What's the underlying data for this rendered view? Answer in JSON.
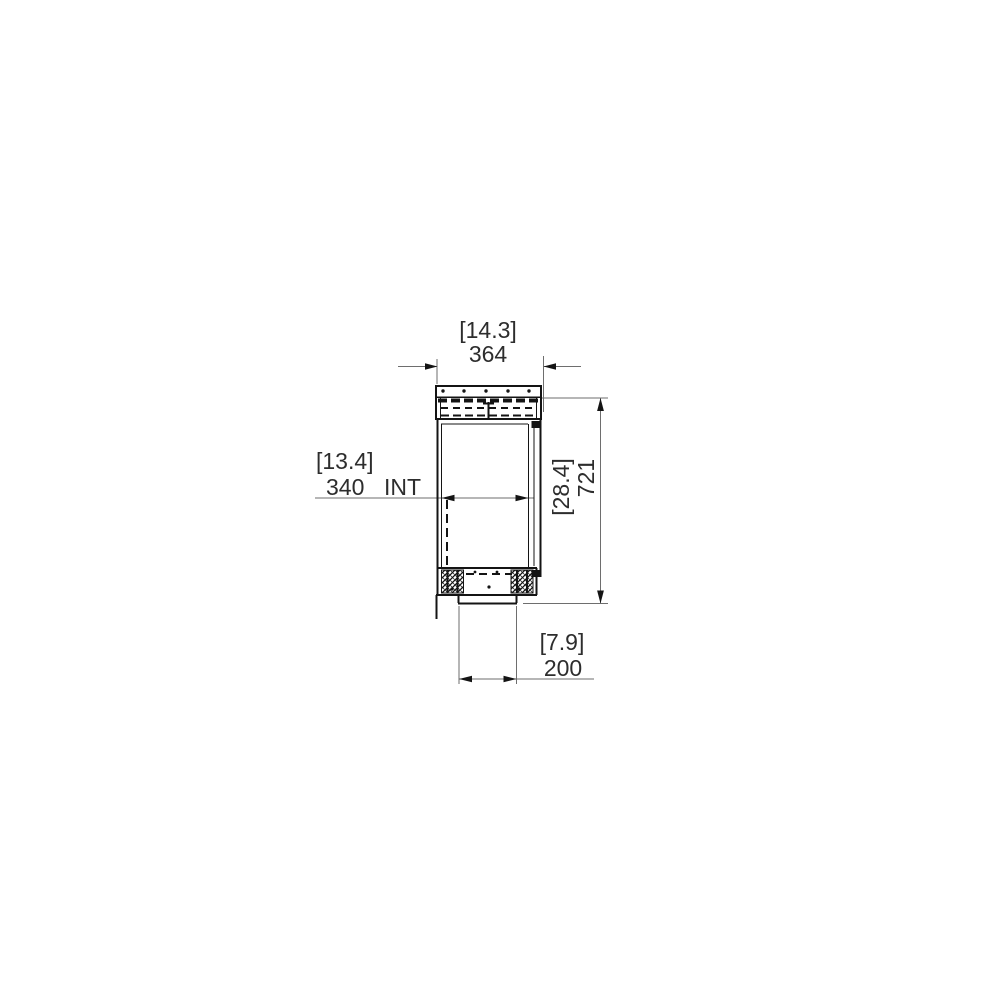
{
  "page": {
    "background": "#ffffff"
  },
  "drawing": {
    "name": "firebox-side-section-technical-drawing",
    "view": "side section with dimension callouts",
    "line_color": "#141414",
    "dim_color": "#6e6e6e",
    "arrow_color": "#141414",
    "text_color": "#2d2d2d",
    "dimensions": {
      "top_width": {
        "inches_bracket": "[14.3]",
        "mm": "364"
      },
      "internal_width": {
        "inches_bracket": "[13.4]",
        "mm": "340",
        "suffix": "INT"
      },
      "overall_height": {
        "inches_bracket": "[28.4]",
        "mm": "721"
      },
      "bottom_width": {
        "inches_bracket": "[7.9]",
        "mm": "200"
      }
    }
  }
}
